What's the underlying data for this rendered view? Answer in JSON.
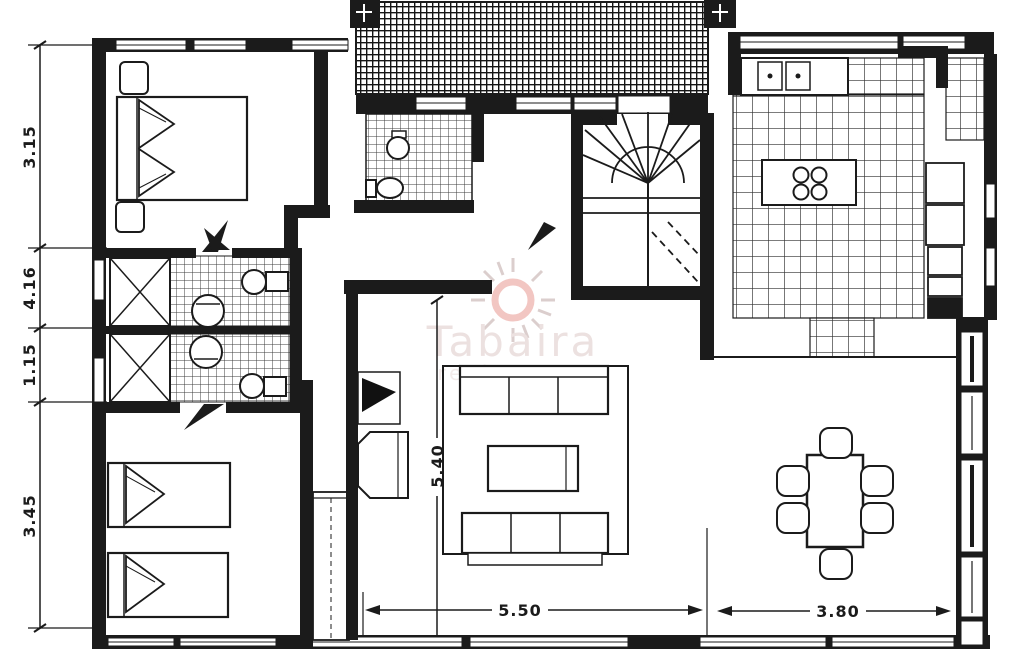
{
  "plan": {
    "watermark": {
      "brand": "Tabaira",
      "tagline": "real estate"
    },
    "dimensions": {
      "left_top": "3.15",
      "left_upper_mid": "4.16",
      "left_lower_mid": "1.15",
      "left_bottom": "3.45",
      "living_depth": "5.40",
      "living_width": "5.50",
      "dining_width": "3.80"
    },
    "colors": {
      "ink": "#1b1b1b",
      "paper": "#ffffff",
      "watermark_ring": "#f2c6c2",
      "watermark_rays": "#dbcecd",
      "watermark_text": "#ece1e0"
    }
  }
}
